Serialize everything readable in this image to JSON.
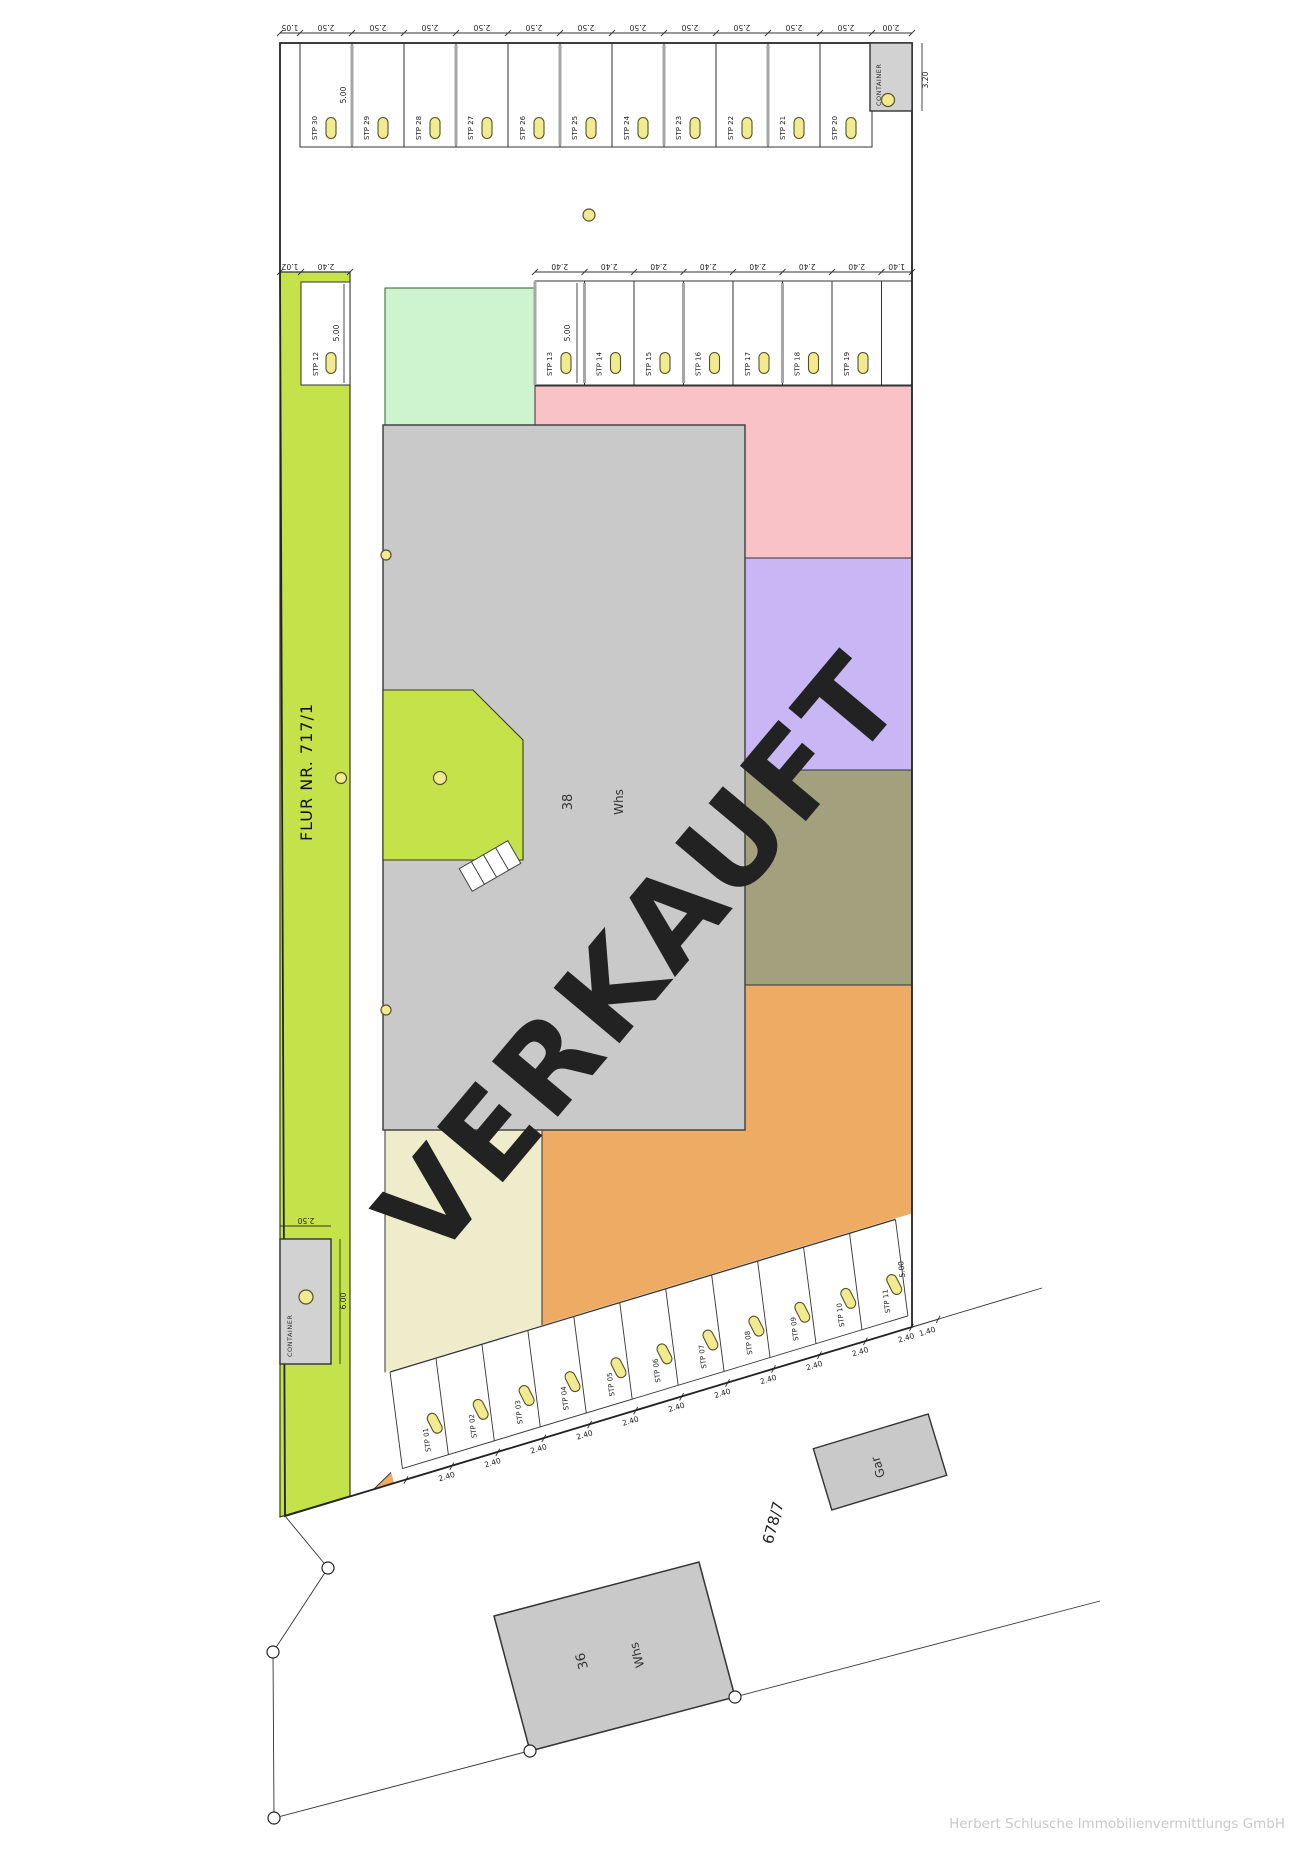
{
  "meta": {
    "stamp": "VERKAUFT",
    "footer": "Herbert Schlusche Immobilienvermittlungs GmbH"
  },
  "colors": {
    "strip_green": "#c6e24b",
    "mint": "#cdf3cf",
    "pink": "#f9c2c6",
    "purple": "#c9b6f4",
    "olive": "#a3a07e",
    "orange": "#edab64",
    "cream": "#efeccb",
    "building": "#c9c9c9",
    "badge": "#f2ea8f",
    "stamp_red": "#e92c25"
  },
  "top_row": {
    "stalls": [
      "STP 30",
      "STP 29",
      "STP 28",
      "STP 27",
      "STP 26",
      "STP 25",
      "STP 24",
      "STP 23",
      "STP 22",
      "STP 21",
      "STP 20"
    ],
    "dim_width": "2.50",
    "dim_depth": "5.00",
    "dim_gap": "1.05",
    "container": {
      "label": "CONTAINER",
      "dim_width": "2.00",
      "dim_depth": "3.20"
    }
  },
  "middle_row": {
    "stalls": [
      "STP 13",
      "STP 14",
      "STP 15",
      "STP 16",
      "STP 17",
      "STP 18",
      "STP 19"
    ],
    "dim_width": "2.40",
    "dim_depth": "5.00",
    "dim_end": "1.40"
  },
  "bottom_row": {
    "stalls": [
      "STP 01",
      "STP 02",
      "STP 03",
      "STP 04",
      "STP 05",
      "STP 06",
      "STP 07",
      "STP 08",
      "STP 09",
      "STP 10",
      "STP 11"
    ],
    "dim_width": "2.40",
    "dim_depth": "5.00",
    "dim_end": "1.40"
  },
  "strip": {
    "flur_label": "FLUR NR. 717/1",
    "stall": "STP 12",
    "dim_gap": "1.02",
    "dim_width": "2.40",
    "dim_depth": "5.00"
  },
  "container_left": {
    "label": "CONTAINER",
    "dim_width": "2.50",
    "dim_depth": "6.00"
  },
  "building_38": {
    "number": "38",
    "type": "Whs"
  },
  "building_36": {
    "number": "36",
    "type": "Whs"
  },
  "garage": {
    "label": "Gar"
  },
  "neighbor_parcel": {
    "label": "678/7"
  }
}
